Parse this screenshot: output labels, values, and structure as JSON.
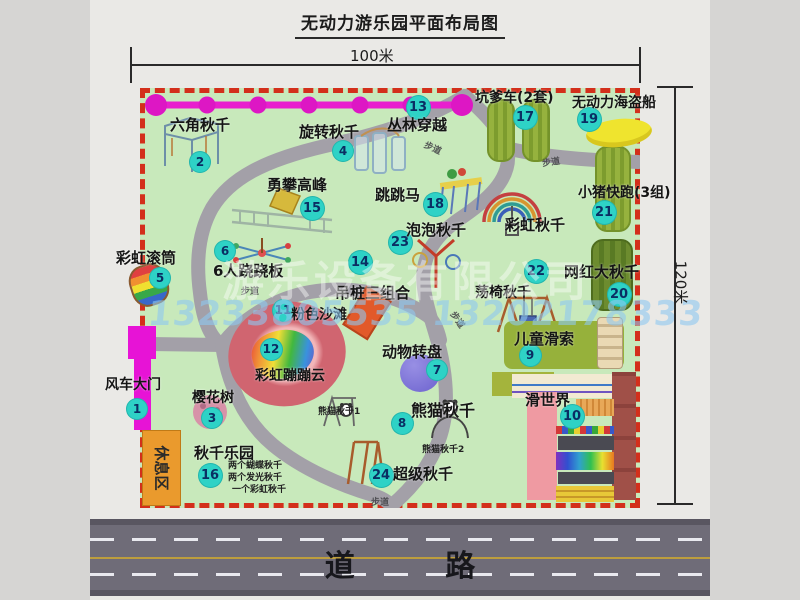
{
  "title": "无动力游乐园平面布局图",
  "dimensions": {
    "width": "100米",
    "height": "120米"
  },
  "road_label": "道 路",
  "rest_area_label": "休息区",
  "path_sign": "步道",
  "watermark": {
    "company": "游乐设备有限公司",
    "phone": "13233805535 13202178333"
  },
  "extra_labels": {
    "rainbow_swing": "彩虹秋千",
    "panda_swing_1": "熊猫秋千1",
    "panda_swing_2": "熊猫秋千2",
    "swing_park_notes": [
      "两个蝴蝶秋千",
      "两个发光秋千",
      "一个彩虹秋千"
    ]
  },
  "colors": {
    "map_green": "#c8e9bb",
    "border_red": "#d32f1b",
    "badge_cyan": "#2ed2c6",
    "gate_magenta": "#e713d6",
    "rest_orange": "#ea9a2d",
    "road_gray": "#6f6c78"
  },
  "attractions": [
    {
      "num": "1",
      "label": "风车大门"
    },
    {
      "num": "2",
      "label": "六角秋千"
    },
    {
      "num": "3",
      "label": "樱花树"
    },
    {
      "num": "4",
      "label": "旋转秋千"
    },
    {
      "num": "5",
      "label": "彩虹滚筒"
    },
    {
      "num": "6",
      "label": "6人跷跷板"
    },
    {
      "num": "7",
      "label": "动物转盘"
    },
    {
      "num": "8",
      "label": "熊猫秋千"
    },
    {
      "num": "9",
      "label": "儿童滑索"
    },
    {
      "num": "10",
      "label": "滑世界"
    },
    {
      "num": "11",
      "label": "粉色沙滩"
    },
    {
      "num": "12",
      "label": "彩虹蹦蹦云"
    },
    {
      "num": "13",
      "label": "丛林穿越"
    },
    {
      "num": "14",
      "label": "吊桩三组合"
    },
    {
      "num": "15",
      "label": "勇攀高峰"
    },
    {
      "num": "16",
      "label": "秋千乐园"
    },
    {
      "num": "17",
      "label": "坑爹车(2套)"
    },
    {
      "num": "18",
      "label": "跳跳马"
    },
    {
      "num": "19",
      "label": "无动力海盗船"
    },
    {
      "num": "20",
      "label": "网红大秋千"
    },
    {
      "num": "21",
      "label": "小猪快跑(3组)"
    },
    {
      "num": "22",
      "label": "荡椅秋千"
    },
    {
      "num": "23",
      "label": "泡泡秋千"
    },
    {
      "num": "24",
      "label": "超级秋千"
    }
  ]
}
